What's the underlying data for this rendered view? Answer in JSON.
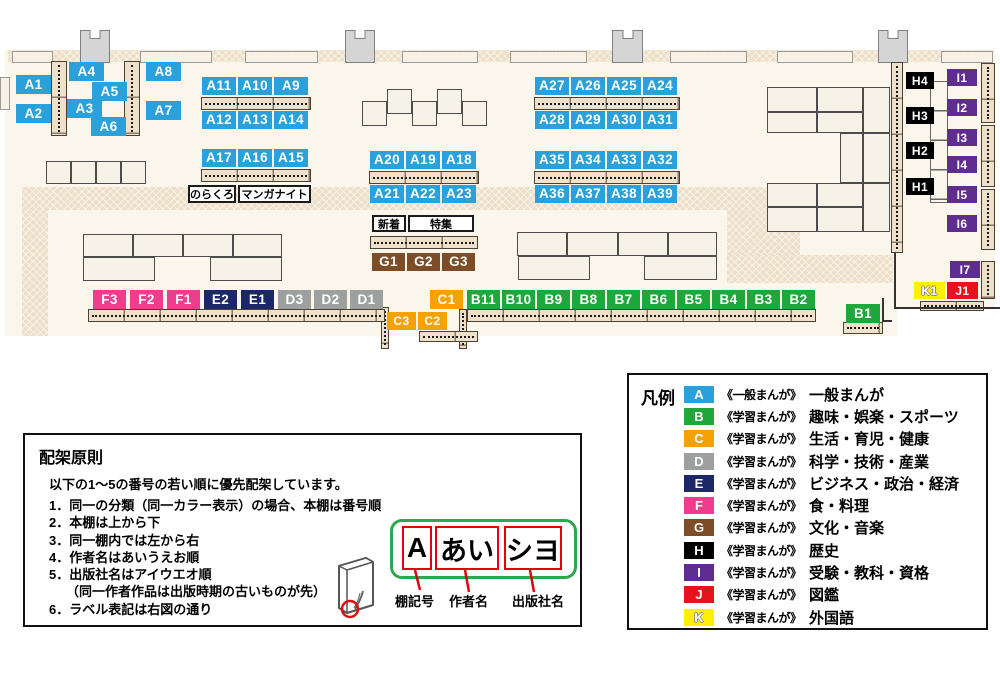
{
  "map": {
    "shelf_labels": [
      {
        "text": "A1",
        "x": 16,
        "y": 75,
        "w": 35,
        "h": 19
      },
      {
        "text": "A2",
        "x": 16,
        "y": 104,
        "w": 35,
        "h": 19
      },
      {
        "text": "A4",
        "x": 69,
        "y": 62,
        "w": 35,
        "h": 19
      },
      {
        "text": "A5",
        "x": 92,
        "y": 82,
        "w": 35,
        "h": 19
      },
      {
        "text": "A3",
        "x": 67,
        "y": 99,
        "w": 35,
        "h": 19
      },
      {
        "text": "A6",
        "x": 91,
        "y": 117,
        "w": 35,
        "h": 19
      },
      {
        "text": "A8",
        "x": 146,
        "y": 62,
        "w": 35,
        "h": 19
      },
      {
        "text": "A7",
        "x": 146,
        "y": 101,
        "w": 35,
        "h": 19
      },
      {
        "text": "A11",
        "x": 202,
        "y": 77,
        "w": 34,
        "h": 18
      },
      {
        "text": "A10",
        "x": 238,
        "y": 77,
        "w": 34,
        "h": 18
      },
      {
        "text": "A9",
        "x": 274,
        "y": 77,
        "w": 34,
        "h": 18
      },
      {
        "text": "A12",
        "x": 202,
        "y": 111,
        "w": 34,
        "h": 18
      },
      {
        "text": "A13",
        "x": 238,
        "y": 111,
        "w": 34,
        "h": 18
      },
      {
        "text": "A14",
        "x": 274,
        "y": 111,
        "w": 34,
        "h": 18
      },
      {
        "text": "A17",
        "x": 202,
        "y": 149,
        "w": 34,
        "h": 18
      },
      {
        "text": "A16",
        "x": 238,
        "y": 149,
        "w": 34,
        "h": 18
      },
      {
        "text": "A15",
        "x": 274,
        "y": 149,
        "w": 34,
        "h": 18
      },
      {
        "text": "A20",
        "x": 370,
        "y": 151,
        "w": 34,
        "h": 18
      },
      {
        "text": "A19",
        "x": 406,
        "y": 151,
        "w": 34,
        "h": 18
      },
      {
        "text": "A18",
        "x": 442,
        "y": 151,
        "w": 34,
        "h": 18
      },
      {
        "text": "A21",
        "x": 370,
        "y": 185,
        "w": 34,
        "h": 18
      },
      {
        "text": "A22",
        "x": 406,
        "y": 185,
        "w": 34,
        "h": 18
      },
      {
        "text": "A23",
        "x": 442,
        "y": 185,
        "w": 34,
        "h": 18
      },
      {
        "text": "A27",
        "x": 535,
        "y": 77,
        "w": 34,
        "h": 18
      },
      {
        "text": "A26",
        "x": 571,
        "y": 77,
        "w": 34,
        "h": 18
      },
      {
        "text": "A25",
        "x": 607,
        "y": 77,
        "w": 34,
        "h": 18
      },
      {
        "text": "A24",
        "x": 643,
        "y": 77,
        "w": 34,
        "h": 18
      },
      {
        "text": "A28",
        "x": 535,
        "y": 111,
        "w": 34,
        "h": 18
      },
      {
        "text": "A29",
        "x": 571,
        "y": 111,
        "w": 34,
        "h": 18
      },
      {
        "text": "A30",
        "x": 607,
        "y": 111,
        "w": 34,
        "h": 18
      },
      {
        "text": "A31",
        "x": 643,
        "y": 111,
        "w": 34,
        "h": 18
      },
      {
        "text": "A35",
        "x": 535,
        "y": 151,
        "w": 34,
        "h": 18
      },
      {
        "text": "A34",
        "x": 571,
        "y": 151,
        "w": 34,
        "h": 18
      },
      {
        "text": "A33",
        "x": 607,
        "y": 151,
        "w": 34,
        "h": 18
      },
      {
        "text": "A32",
        "x": 643,
        "y": 151,
        "w": 34,
        "h": 18
      },
      {
        "text": "A36",
        "x": 535,
        "y": 185,
        "w": 34,
        "h": 18
      },
      {
        "text": "A37",
        "x": 571,
        "y": 185,
        "w": 34,
        "h": 18
      },
      {
        "text": "A38",
        "x": 607,
        "y": 185,
        "w": 34,
        "h": 18
      },
      {
        "text": "A39",
        "x": 643,
        "y": 185,
        "w": 34,
        "h": 18
      },
      {
        "text": "G1",
        "x": 372,
        "y": 253,
        "w": 33,
        "h": 18
      },
      {
        "text": "G2",
        "x": 407,
        "y": 253,
        "w": 33,
        "h": 18
      },
      {
        "text": "G3",
        "x": 442,
        "y": 253,
        "w": 33,
        "h": 18
      },
      {
        "text": "F3",
        "x": 93,
        "y": 290,
        "w": 33,
        "h": 19
      },
      {
        "text": "F2",
        "x": 130,
        "y": 290,
        "w": 33,
        "h": 19
      },
      {
        "text": "F1",
        "x": 167,
        "y": 290,
        "w": 33,
        "h": 19
      },
      {
        "text": "E2",
        "x": 204,
        "y": 290,
        "w": 33,
        "h": 19
      },
      {
        "text": "E1",
        "x": 241,
        "y": 290,
        "w": 33,
        "h": 19
      },
      {
        "text": "D3",
        "x": 278,
        "y": 290,
        "w": 33,
        "h": 19
      },
      {
        "text": "D2",
        "x": 314,
        "y": 290,
        "w": 33,
        "h": 19
      },
      {
        "text": "D1",
        "x": 350,
        "y": 290,
        "w": 33,
        "h": 19
      },
      {
        "text": "C1",
        "x": 430,
        "y": 290,
        "w": 33,
        "h": 19
      },
      {
        "text": "B11",
        "x": 467,
        "y": 290,
        "w": 33,
        "h": 19
      },
      {
        "text": "B10",
        "x": 502,
        "y": 290,
        "w": 33,
        "h": 19
      },
      {
        "text": "B9",
        "x": 537,
        "y": 290,
        "w": 33,
        "h": 19
      },
      {
        "text": "B8",
        "x": 572,
        "y": 290,
        "w": 33,
        "h": 19
      },
      {
        "text": "B7",
        "x": 607,
        "y": 290,
        "w": 33,
        "h": 19
      },
      {
        "text": "B6",
        "x": 642,
        "y": 290,
        "w": 33,
        "h": 19
      },
      {
        "text": "B5",
        "x": 677,
        "y": 290,
        "w": 33,
        "h": 19
      },
      {
        "text": "B4",
        "x": 712,
        "y": 290,
        "w": 33,
        "h": 19
      },
      {
        "text": "B3",
        "x": 747,
        "y": 290,
        "w": 33,
        "h": 19
      },
      {
        "text": "B2",
        "x": 782,
        "y": 290,
        "w": 33,
        "h": 19
      },
      {
        "text": "C3",
        "x": 387,
        "y": 312,
        "w": 29,
        "h": 18
      },
      {
        "text": "C2",
        "x": 418,
        "y": 312,
        "w": 29,
        "h": 18
      },
      {
        "text": "B1",
        "x": 846,
        "y": 304,
        "w": 34,
        "h": 19
      },
      {
        "text": "H4",
        "x": 906,
        "y": 72,
        "w": 28,
        "h": 17
      },
      {
        "text": "H3",
        "x": 906,
        "y": 107,
        "w": 28,
        "h": 17
      },
      {
        "text": "H2",
        "x": 906,
        "y": 142,
        "w": 28,
        "h": 17
      },
      {
        "text": "H1",
        "x": 906,
        "y": 178,
        "w": 28,
        "h": 17
      },
      {
        "text": "I1",
        "x": 947,
        "y": 69,
        "w": 30,
        "h": 17
      },
      {
        "text": "I2",
        "x": 947,
        "y": 99,
        "w": 30,
        "h": 17
      },
      {
        "text": "I3",
        "x": 947,
        "y": 129,
        "w": 30,
        "h": 17
      },
      {
        "text": "I4",
        "x": 947,
        "y": 156,
        "w": 30,
        "h": 17
      },
      {
        "text": "I5",
        "x": 947,
        "y": 186,
        "w": 30,
        "h": 17
      },
      {
        "text": "I6",
        "x": 947,
        "y": 215,
        "w": 30,
        "h": 17
      },
      {
        "text": "I7",
        "x": 950,
        "y": 261,
        "w": 30,
        "h": 17
      },
      {
        "text": "K1",
        "x": 914,
        "y": 282,
        "w": 31,
        "h": 17
      },
      {
        "text": "J1",
        "x": 947,
        "y": 282,
        "w": 31,
        "h": 17
      }
    ],
    "callouts": [
      {
        "text": "のらくろ",
        "x": 188,
        "y": 185,
        "w": 48,
        "h": 18
      },
      {
        "text": "マンガナイト",
        "x": 238,
        "y": 185,
        "w": 73,
        "h": 18
      },
      {
        "text": "新着",
        "x": 372,
        "y": 215,
        "w": 34,
        "h": 17
      },
      {
        "text": "特集",
        "x": 408,
        "y": 215,
        "w": 66,
        "h": 17
      }
    ]
  },
  "legend": {
    "title": "凡例",
    "items": [
      {
        "letter": "A",
        "color": "#2aa1db",
        "source": "《一般まんが》",
        "category": "一般まんが"
      },
      {
        "letter": "B",
        "color": "#1fa73c",
        "source": "《学習まんが》",
        "category": "趣味・娯楽・スポーツ"
      },
      {
        "letter": "C",
        "color": "#f5a100",
        "source": "《学習まんが》",
        "category": "生活・育児・健康"
      },
      {
        "letter": "D",
        "color": "#9ea0a0",
        "source": "《学習まんが》",
        "category": "科学・技術・産業"
      },
      {
        "letter": "E",
        "color": "#1c2768",
        "source": "《学習まんが》",
        "category": "ビジネス・政治・経済"
      },
      {
        "letter": "F",
        "color": "#ee3d8d",
        "source": "《学習まんが》",
        "category": "食・料理"
      },
      {
        "letter": "G",
        "color": "#7c4d26",
        "source": "《学習まんが》",
        "category": "文化・音楽"
      },
      {
        "letter": "H",
        "color": "#000000",
        "source": "《学習まんが》",
        "category": "歴史"
      },
      {
        "letter": "I",
        "color": "#5f2c90",
        "source": "《学習まんが》",
        "category": "受験・教科・資格"
      },
      {
        "letter": "J",
        "color": "#e8121e",
        "source": "《学習まんが》",
        "category": "図鑑"
      },
      {
        "letter": "K",
        "color": "#fff000",
        "source": "《学習まんが》",
        "category": "外国語"
      }
    ]
  },
  "principles": {
    "title": "配架原則",
    "intro": "以下の1～5の番号の若い順に優先配架しています。",
    "items": [
      "1．同一の分類（同一カラー表示）の場合、本棚は番号順",
      "2．本棚は上から下",
      "3．同一棚内では左から右",
      "4．作者名はあいうえお順",
      "5．出版社名はアイウエオ順",
      "（同一作者作品は出版時期の古いものが先）",
      "6．ラベル表記は右図の通り"
    ],
    "label_diagram": {
      "segments": [
        {
          "text": "A"
        },
        {
          "text": "あい"
        },
        {
          "text": "シヨ"
        }
      ],
      "captions": [
        "棚記号",
        "作者名",
        "出版社名"
      ]
    }
  }
}
